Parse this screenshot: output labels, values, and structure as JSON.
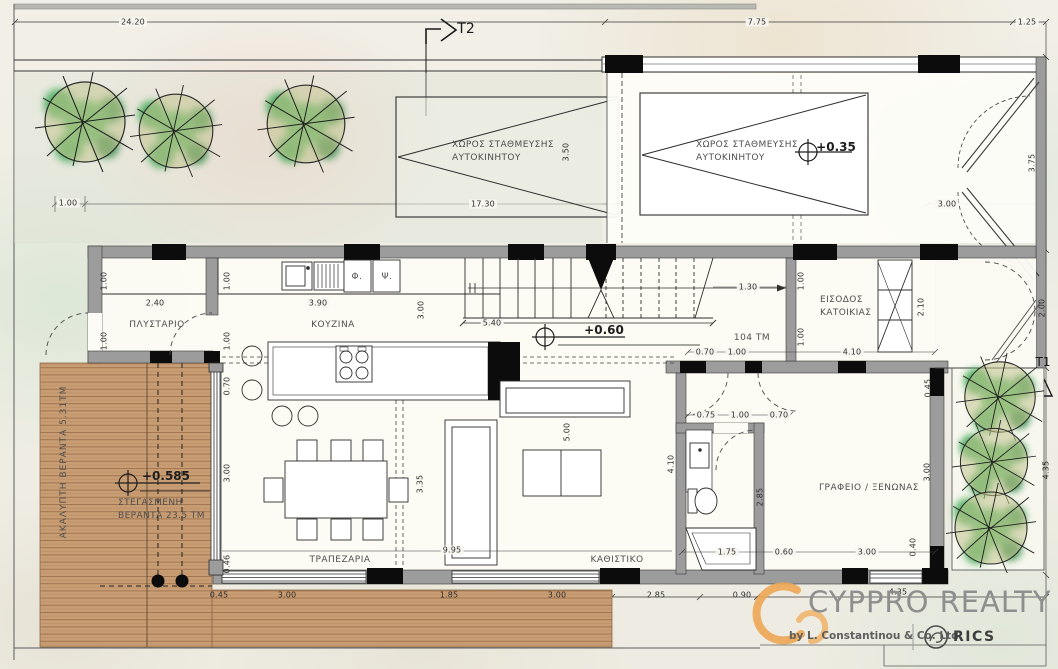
{
  "plan": {
    "section_markers": {
      "t2": "T2",
      "t1": "Τ1"
    },
    "levels": {
      "garage": "+0.35",
      "ground": "+0.60",
      "veranda": "+0.585"
    },
    "area_label": "104 ΤΜ",
    "rooms": {
      "parking1_l1": "ΧΩΡΟΣ ΣΤΑΘΜΕΥΣΗΣ",
      "parking1_l2": "ΑΥΤΟΚΙΝΗΤΟΥ",
      "parking2_l1": "ΧΩΡΟΣ ΣΤΑΘΜΕΥΣΗΣ",
      "parking2_l2": "ΑΥΤΟΚΙΝΗΤΟΥ",
      "laundry": "ΠΛΥΣΤΑΡΙΟ",
      "kitchen": "ΚΟΥΖΙΝΑ",
      "dining": "ΤΡΑΠΕΖΑΡΙΑ",
      "living": "ΚΑΘΙΣΤΙΚΟ",
      "office": "ΓΡΑΦΕΙΟ / ΞΕΝΩΝΑΣ",
      "entrance_l1": "ΕΙΣΟΔΟΣ",
      "entrance_l2": "ΚΑΤΟΙΚΙΑΣ",
      "covered_veranda_l1": "ΣΤΕΓΑΣΜΕΝΗ",
      "covered_veranda_l2": "ΒΕΡΑΝΤΑ 23.5 ΤΜ",
      "open_veranda": "ΑΚΑΛΥΠΤΗ ΒΕΡΑΝΤΑ 5.31ΤΜ",
      "appliance_f": "Φ.",
      "appliance_p": "Ψ."
    },
    "site_dims": {
      "d2420": "24.20",
      "d775": "7.75",
      "d125": "1.25",
      "d100": "1.00",
      "d1730": "17.30",
      "d350": "3.50",
      "d300g": "3.00",
      "d375": "3.75",
      "d200": "2.00",
      "d435r": "4.35"
    },
    "dims": {
      "l100a": "1.00",
      "l100b": "1.00",
      "l240": "2.40",
      "k100a": "1.00",
      "k100b": "1.00",
      "k070": "0.70",
      "k390": "3.90",
      "k300": "3.00",
      "s540": "5.40",
      "s130": "1.30",
      "e070": "0.70",
      "e100": "1.00",
      "e410": "4.10",
      "e100a": "1.00",
      "e100b": "1.00",
      "e210": "2.10",
      "e045": "0.45",
      "b075": "0.75",
      "b100": "1.00",
      "b070": "0.70",
      "b410": "4.10",
      "b285": "2.85",
      "b175": "1.75",
      "b060": "0.60",
      "b300": "3.00",
      "o300": "3.00",
      "o040": "0.40",
      "lv500": "5.00",
      "dn335": "3.35",
      "dn995": "9.95",
      "v300": "3.00",
      "v046": "0.46",
      "bt045": "0.45",
      "bt300a": "3.00",
      "bt185": "1.85",
      "bt300b": "3.00",
      "bt285": "2.85",
      "bt090": "0.90",
      "bt435": "4.35"
    }
  },
  "branding": {
    "name": "CYPPRO REALTY",
    "byline": "by L. Constantinou & Co. Ltd",
    "rics": "RICS"
  },
  "colors": {
    "accent_orange": "#eca654",
    "wood": "#c89d73",
    "tree_green": "#2f9f44",
    "wall_gray": "#9c9c9c"
  }
}
